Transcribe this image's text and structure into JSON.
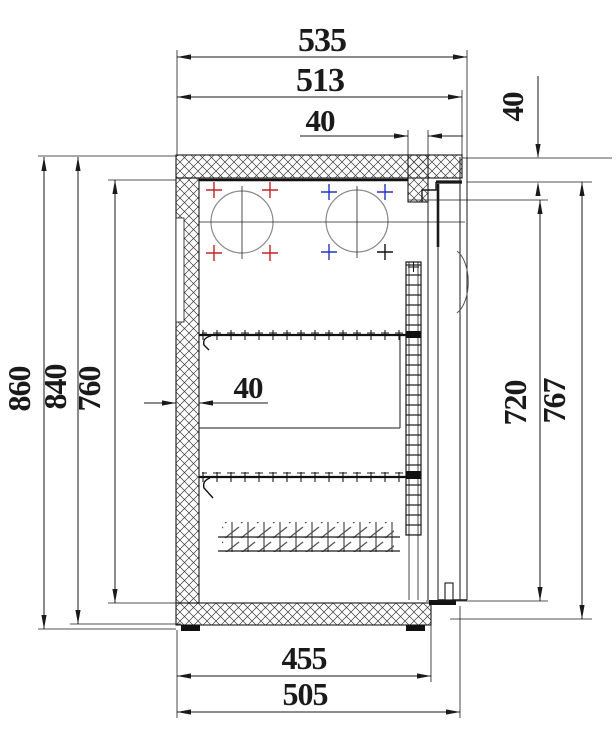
{
  "drawing": {
    "type": "technical-section-drawing",
    "subject": "refrigerated back-bar cabinet side section",
    "units": "mm",
    "line_color": "#1a1a1a",
    "circle_color": "#8a8a8a",
    "datum_colors": {
      "left_fan_marks": "#c42323",
      "right_fan_marks": "#2333c4",
      "right_fan_dark_mark": "#111111"
    },
    "dimensions": {
      "top": {
        "overall_width": "535",
        "body_width": "513",
        "rear_duct_width": "40"
      },
      "right": {
        "top_step_height": "40",
        "opening_height": "720",
        "door_height": "767"
      },
      "left": {
        "overall_height": "860",
        "body_height": "840",
        "interior_height": "760"
      },
      "interior": {
        "wall_thickness": "40"
      },
      "bottom": {
        "interior_depth": "455",
        "base_depth": "505"
      }
    },
    "parts": [
      "insulated top wall",
      "insulated rear wall",
      "insulated bottom wall",
      "front pillar",
      "fan cutout left",
      "fan cutout right",
      "wire shelf upper",
      "wire shelf lower",
      "finned condenser coil",
      "shelf support rack",
      "door assembly",
      "door handle recess",
      "door bottom seal",
      "adjustable feet"
    ]
  }
}
